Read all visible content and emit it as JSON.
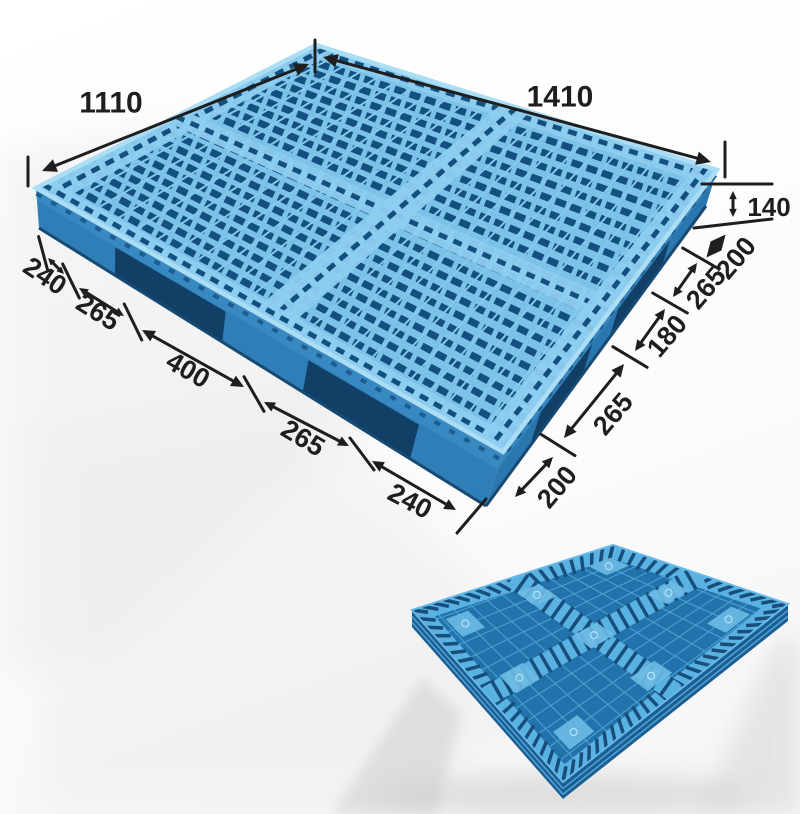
{
  "diagram": {
    "subject": "blue-plastic-grid-pallet",
    "views": [
      "top-perspective-with-dimensions",
      "bottom-underside-view"
    ]
  },
  "dims": {
    "top_edge": "1410",
    "side_edge": "1110",
    "height": "140",
    "right_chain": [
      "200",
      "265",
      "180",
      "265",
      "200"
    ],
    "left_chain": [
      "240",
      "265",
      "400",
      "265",
      "240"
    ]
  },
  "colors": {
    "deck_light": "#7bc1e8",
    "deck_band": "#8ecdef",
    "hole_dark": "#14507f",
    "rib_light": "#85c8ec",
    "rim": "#abddf5",
    "side_left": "#2f7eb8",
    "side_right": "#2a76af",
    "side_shadow": "#123f66",
    "small_base": "#2273ab",
    "small_stripe": "#5ab2e2",
    "small_dark": "#174e7c",
    "small_grid": "#4aa0d2",
    "annotation_line": "#1e1e1e",
    "bg_shadow": "#e6e6e6"
  }
}
